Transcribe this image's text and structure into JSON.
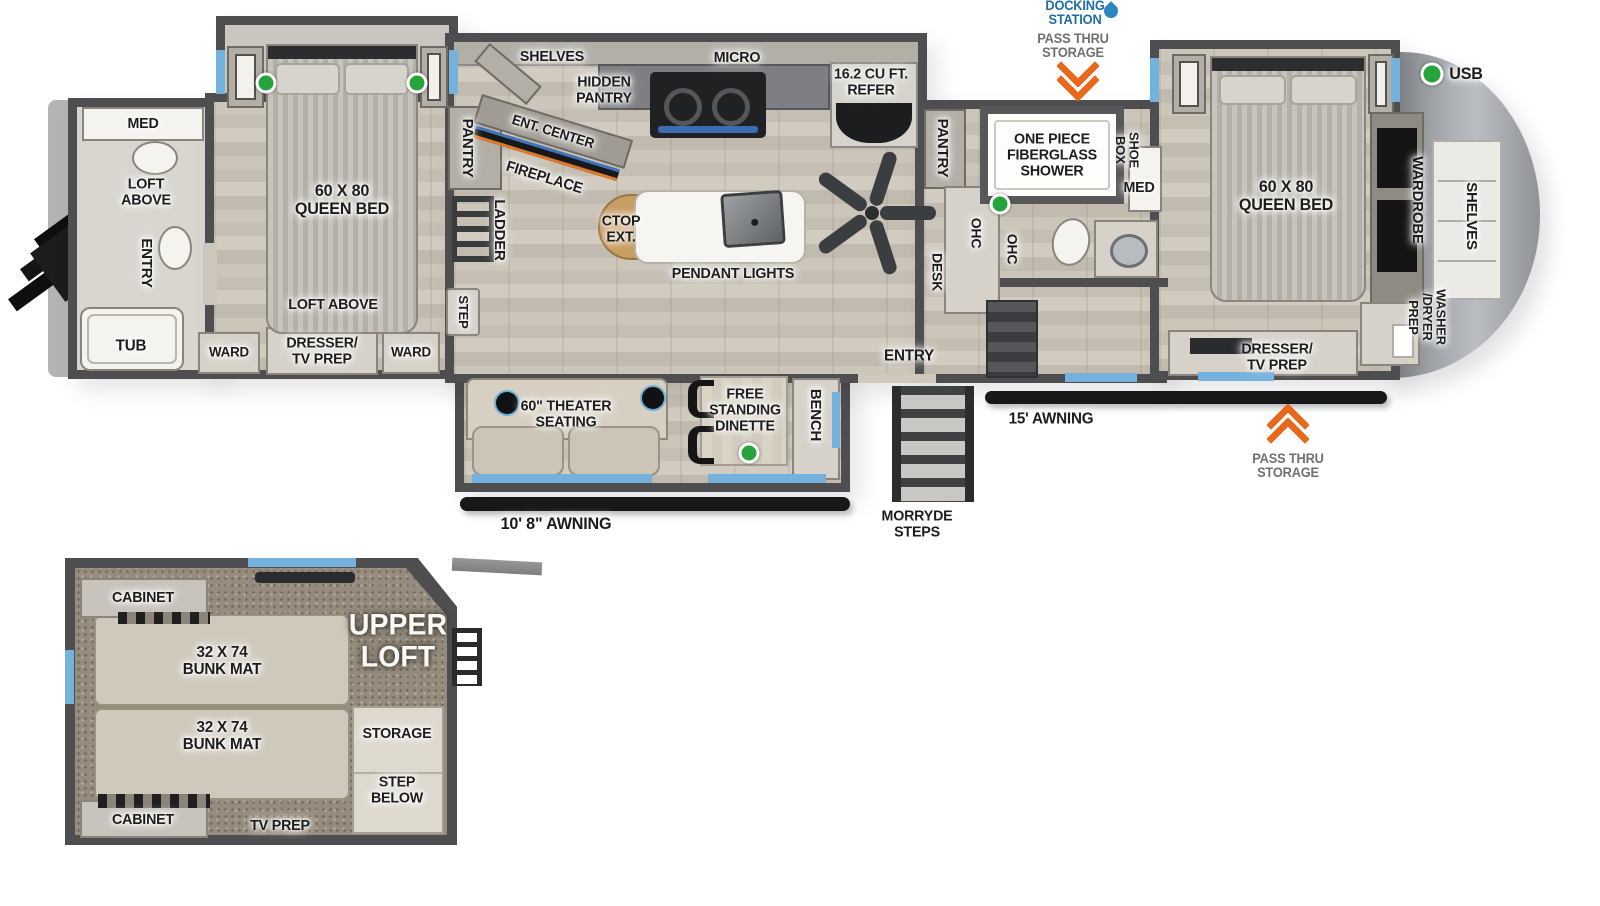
{
  "colors": {
    "wall": "#4e4e50",
    "accent_blue": "#74b2dd",
    "docking_blue": "#1d6ea6",
    "arrow_orange": "#e8681c",
    "usb_green": "#27a33c",
    "annotation_gray": "#707070"
  },
  "labels": {
    "rear_bath_med": "MED",
    "rear_bath_loft_above": "LOFT\nABOVE",
    "rear_bath_entry": "ENTRY",
    "rear_bath_tub": "TUB",
    "rear_bed": "60 X 80\nQUEEN BED",
    "rear_loft_above": "LOFT ABOVE",
    "rear_ward_left": "WARD",
    "rear_dresser": "DRESSER/\nTV PREP",
    "rear_ward_right": "WARD",
    "pantry_rear": "PANTRY",
    "ladder": "LADDER",
    "step": "STEP",
    "kitchen_shelves": "SHELVES",
    "hidden_pantry": "HIDDEN\nPANTRY",
    "ent_center": "ENT. CENTER",
    "fireplace": "FIREPLACE",
    "micro": "MICRO",
    "refer": "16.2 CU FT.\nREFER",
    "ctop_ext": "CTOP\nEXT.",
    "pendant_lights": "PENDANT LIGHTS",
    "pantry_mid": "PANTRY",
    "ohc_desk": "OHC",
    "desk": "DESK",
    "ohc_bath": "OHC",
    "entry_main": "ENTRY",
    "shower": "ONE PIECE\nFIBERGLASS\nSHOWER",
    "shoe_box": "SHOE\nBOX",
    "med_mid": "MED",
    "front_bed": "60 X 80\nQUEEN BED",
    "wardrobe": "WARDROBE",
    "front_shelves": "SHELVES",
    "washer_dryer": "WASHER\n/DRYER\nPREP",
    "front_dresser": "DRESSER/\nTV PREP",
    "usb": "USB",
    "docking_station": "DOCKING\nSTATION",
    "pass_thru_top": "PASS THRU\nSTORAGE",
    "pass_thru_bottom": "PASS THRU\nSTORAGE",
    "theater_seating": "60\" THEATER\nSEATING",
    "dinette": "FREE\nSTANDING\nDINETTE",
    "bench": "BENCH",
    "awning_slide": "10' 8\" AWNING",
    "morryde_steps": "MORRYDE\nSTEPS",
    "awning_main": "15' AWNING",
    "loft_cabinet_top": "CABINET",
    "loft_bunk_top": "32 X 74\nBUNK MAT",
    "upper_loft": "UPPER\nLOFT",
    "loft_storage": "STORAGE",
    "loft_bunk_bottom": "32 X 74\nBUNK MAT",
    "loft_step_below": "STEP\nBELOW",
    "loft_cabinet_bottom": "CABINET",
    "loft_tv_prep": "TV PREP"
  }
}
